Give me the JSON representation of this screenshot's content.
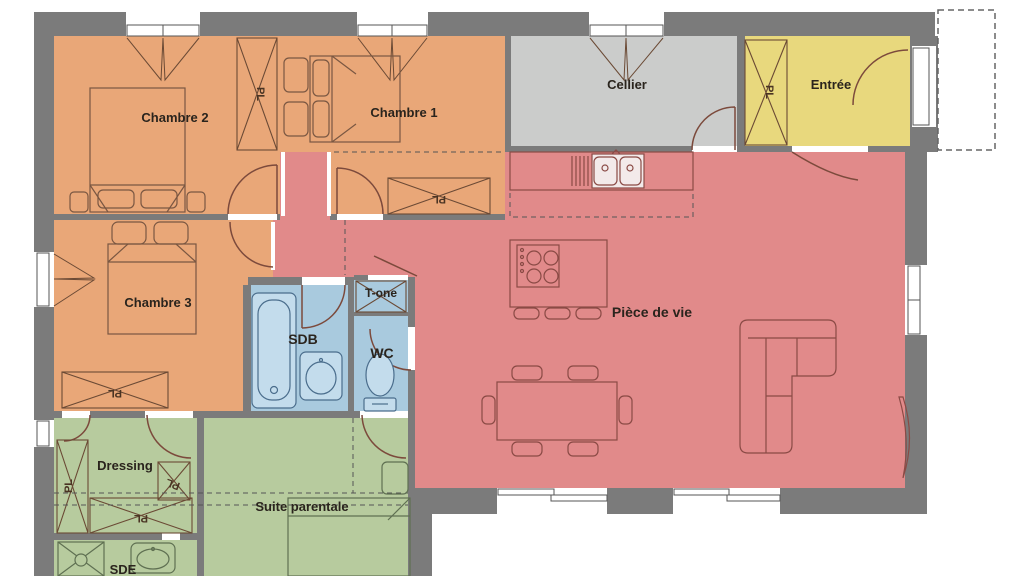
{
  "plan": {
    "rooms": {
      "chambre2": "Chambre 2",
      "chambre1": "Chambre 1",
      "cellier": "Cellier",
      "entree": "Entrée",
      "chambre3": "Chambre 3",
      "sdb": "SDB",
      "technical": "T-one",
      "wc": "WC",
      "piece_de_vie": "Pièce de vie",
      "dressing": "Dressing",
      "suite_parentale": "Suite parentale",
      "sde": "SDE"
    },
    "closet_label": "PL",
    "colors": {
      "wall": "#7b7b7b",
      "bedroom_fill": "#e9a778",
      "living_fill": "#e18a8a",
      "storage_fill": "#cbcccb",
      "entry_fill": "#e8d87d",
      "water_fill": "#a9cade",
      "suite_fill": "#b7cb9e"
    }
  }
}
